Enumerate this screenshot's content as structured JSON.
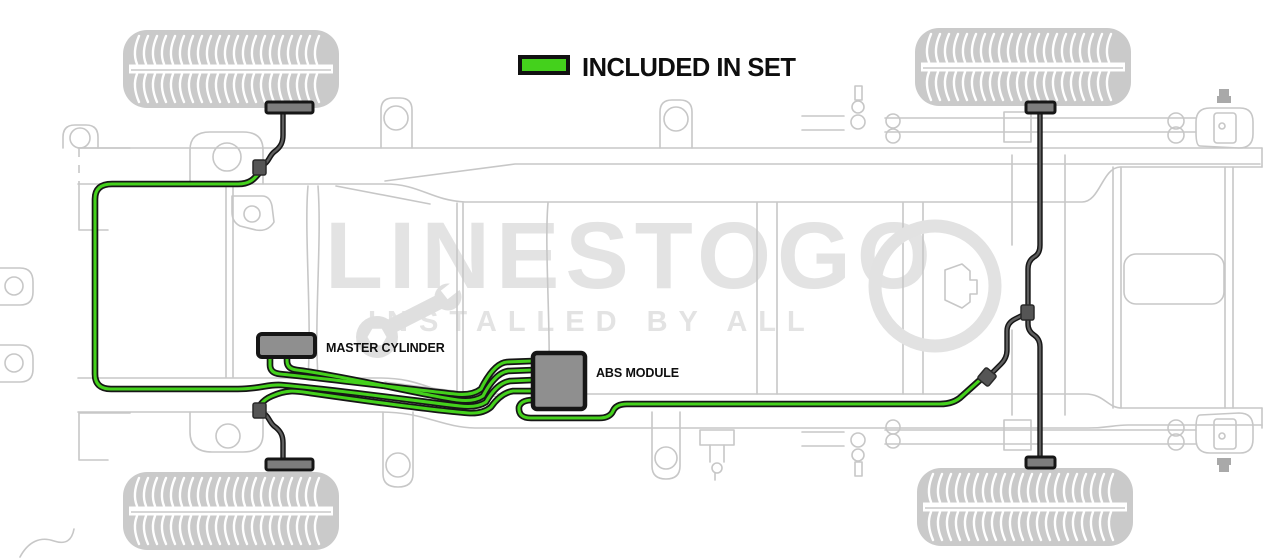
{
  "legend": {
    "label": "INCLUDED IN SET",
    "swatch_color": "#44d11c"
  },
  "components": {
    "master_cylinder": "MASTER CYLINDER",
    "abs_module": "ABS MODULE"
  },
  "watermark": {
    "brand": "LINESTOGO",
    "tagline": "INSTALLED BY ALL"
  },
  "colors": {
    "included_line_green": "#44d11c",
    "line_outline_black": "#161616",
    "excluded_line_gray": "#5f5f5f",
    "component_fill_gray": "#8f8f8f",
    "frame_line_gray": "#c7c7c7",
    "tire_gray": "#cacaca",
    "watermark_gray": "#e3e3e3",
    "background": "#ffffff"
  }
}
